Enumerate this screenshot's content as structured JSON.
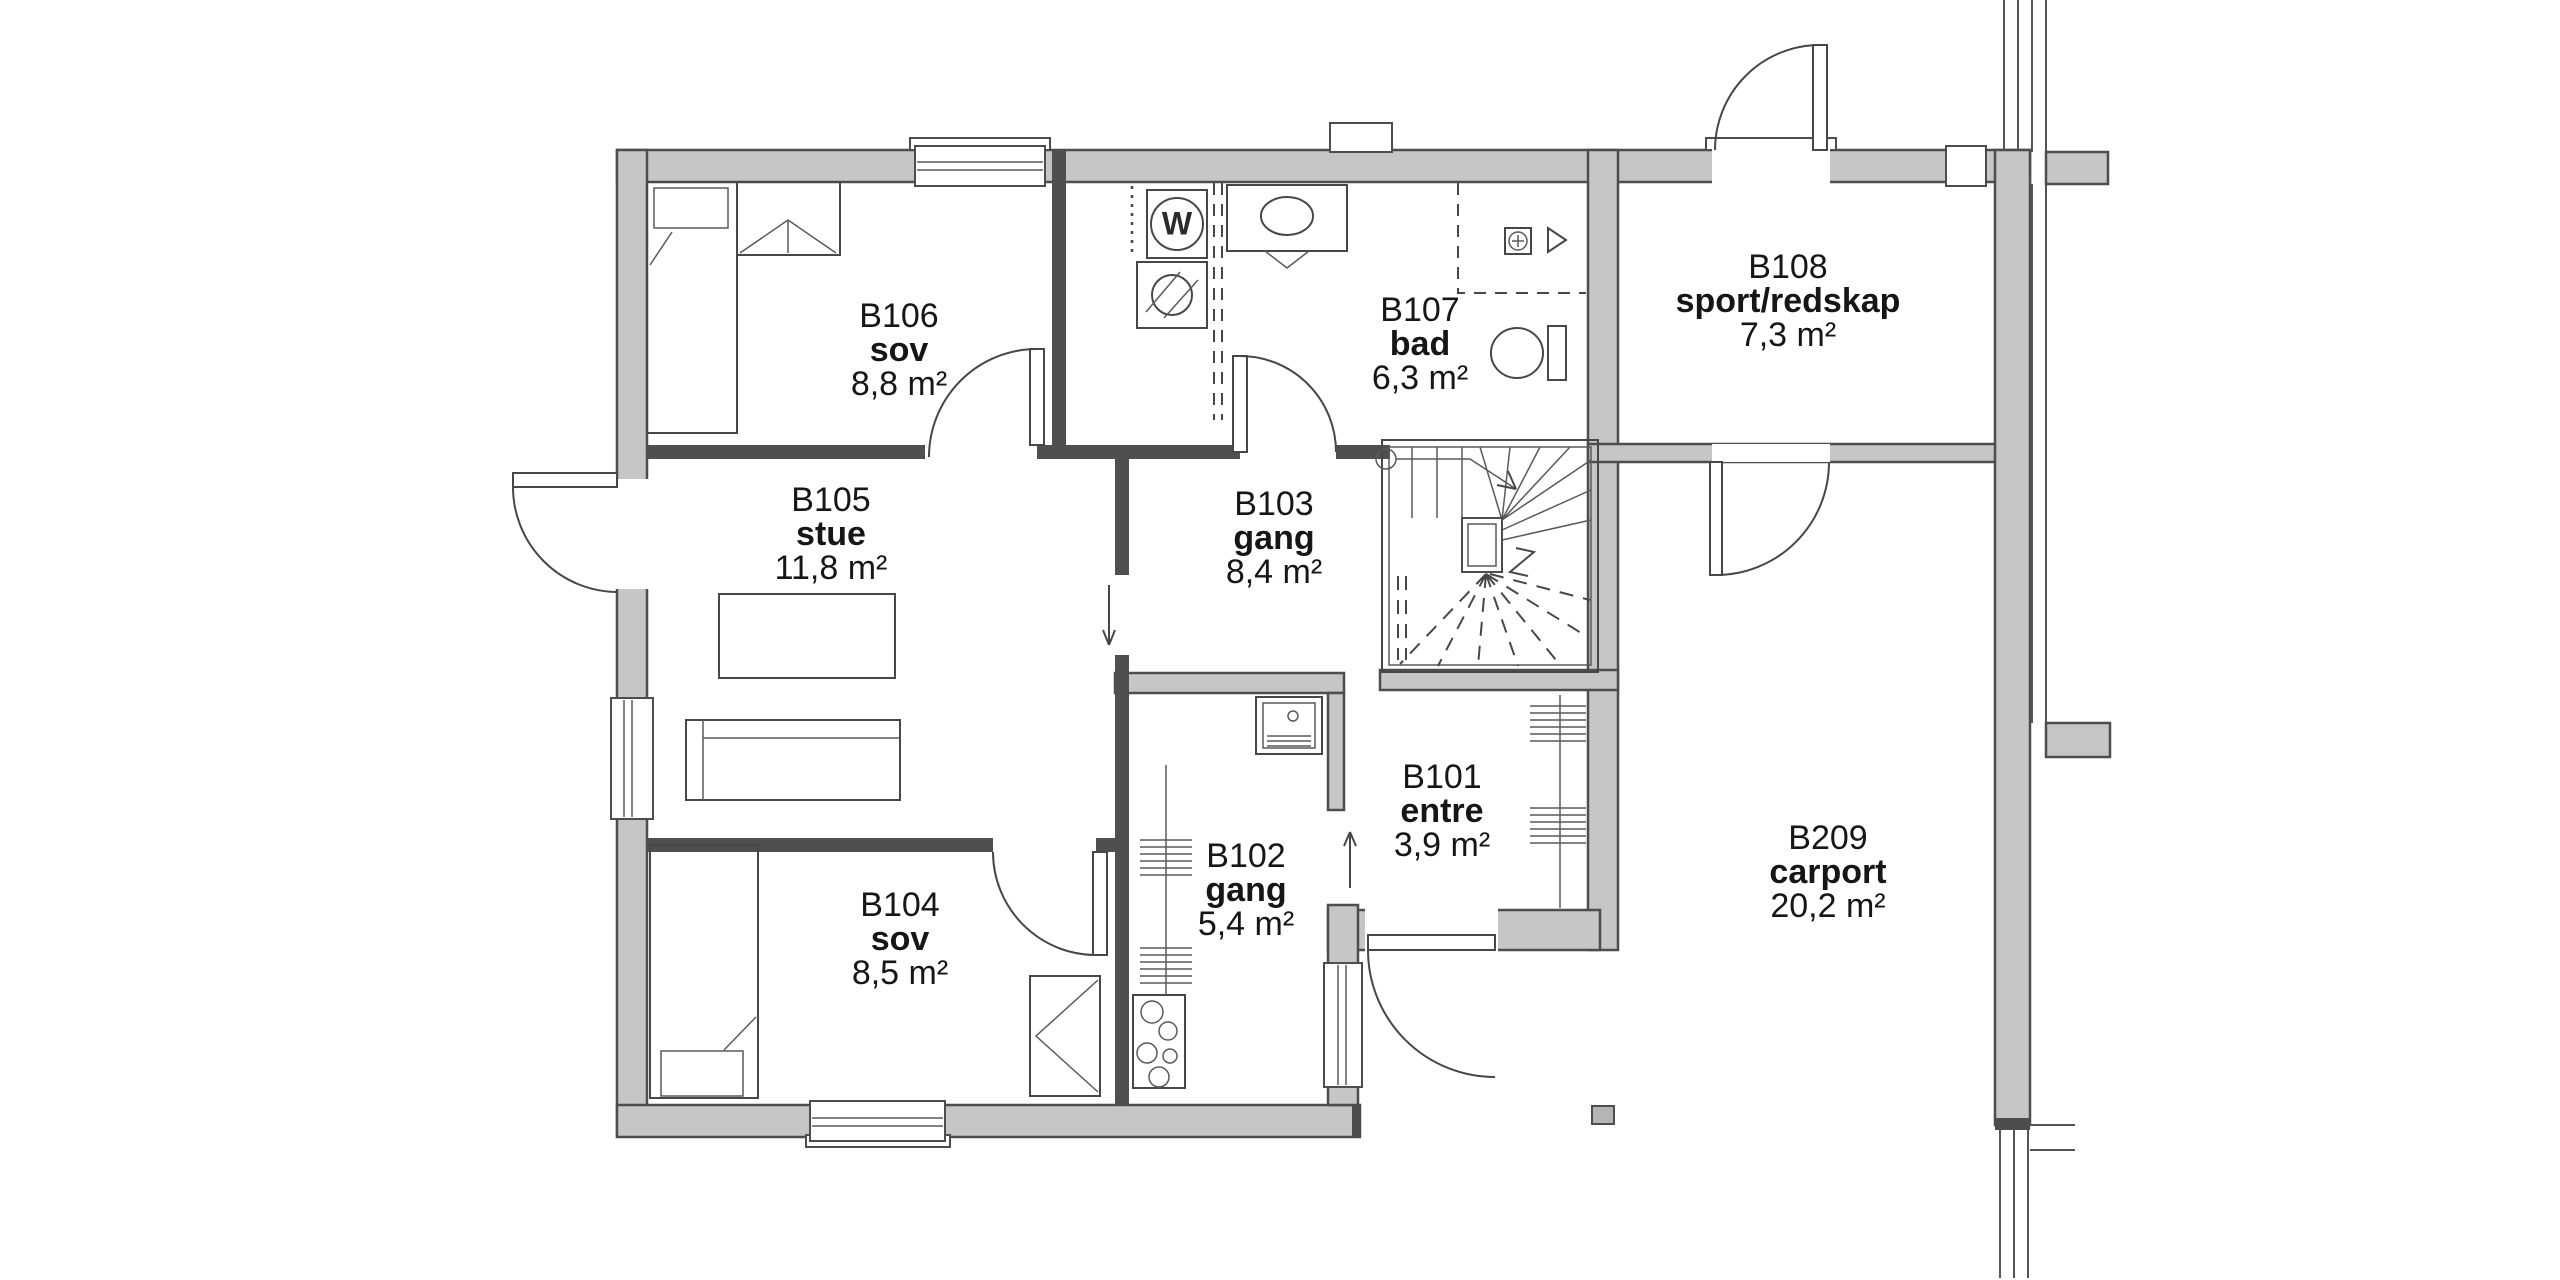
{
  "plan_title": "floor plan level 1",
  "colors": {
    "background": "#ffffff",
    "wall_fill": "#c6c6c6",
    "wall_stroke": "#4d4d4d",
    "interior_wall": "#4f4f4f",
    "line": "#474747",
    "text": "#161616"
  },
  "rooms": [
    {
      "id": "B106",
      "name": "sov",
      "area": "8,8 m²",
      "label_x": 899,
      "label_y": 318
    },
    {
      "id": "B107",
      "name": "bad",
      "area": "6,3 m²",
      "label_x": 1420,
      "label_y": 312
    },
    {
      "id": "B108",
      "name": "sport/redskap",
      "area": "7,3 m²",
      "label_x": 1788,
      "label_y": 269
    },
    {
      "id": "B105",
      "name": "stue",
      "area": "11,8 m²",
      "label_x": 831,
      "label_y": 502
    },
    {
      "id": "B103",
      "name": "gang",
      "area": "8,4 m²",
      "label_x": 1274,
      "label_y": 506
    },
    {
      "id": "B101",
      "name": "entre",
      "area": "3,9 m²",
      "label_x": 1442,
      "label_y": 779
    },
    {
      "id": "B102",
      "name": "gang",
      "area": "5,4 m²",
      "label_x": 1246,
      "label_y": 858
    },
    {
      "id": "B104",
      "name": "sov",
      "area": "8,5 m²",
      "label_x": 900,
      "label_y": 907
    },
    {
      "id": "B209",
      "name": "carport",
      "area": "20,2 m²",
      "label_x": 1828,
      "label_y": 840
    }
  ],
  "fixtures": {
    "washing_machine_symbol": "W"
  }
}
